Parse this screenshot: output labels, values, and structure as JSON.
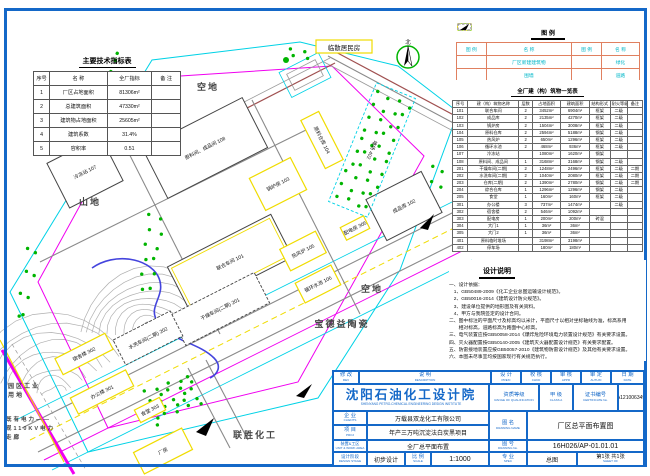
{
  "palette": {
    "blue": "#1468c8",
    "cyan": "#00d2e6",
    "magenta": "#f000f0",
    "yellow": "#f0dc00",
    "green": "#00b400",
    "road_gray": "#8a8a8a",
    "pond_blue": "#4444dd",
    "legend_border": "#e08060"
  },
  "indicators_table": {
    "title": "主要技术指标表",
    "headers": [
      "序号",
      "名  称",
      "全厂指标",
      "备 注"
    ],
    "rows": [
      [
        "1",
        "厂区占地面积",
        "81306m²",
        ""
      ],
      [
        "2",
        "总建筑面积",
        "47330m²",
        ""
      ],
      [
        "3",
        "建筑物占地面积",
        "25605m²",
        ""
      ],
      [
        "4",
        "建筑系数",
        "31.4%",
        ""
      ],
      [
        "5",
        "容积率",
        "0.51",
        ""
      ]
    ]
  },
  "legend": {
    "title": "图  例",
    "headers": [
      "图  例",
      "名  称",
      "图  例",
      "名  称"
    ],
    "rows": [
      {
        "glyph": "new-building",
        "name": "厂区新建建筑物",
        "glyph2": "greenery",
        "name2": "绿化"
      },
      {
        "glyph": "fence",
        "name": "围墙",
        "glyph2": "road",
        "name2": "道路"
      },
      {
        "glyph": "old-building",
        "name": "厂区原有建筑物",
        "glyph2": "gate",
        "name2": "出入口"
      }
    ]
  },
  "buildings_table": {
    "title": "全厂建（构）筑物一览表",
    "headers": [
      "序号",
      "建（构）筑物名称",
      "层数",
      "占地面积",
      "建筑面积",
      "结构形式",
      "耐火等级",
      "备注"
    ],
    "rows": [
      [
        "101",
        "联合车间",
        "2",
        "3452m²",
        "6904m²",
        "框架",
        "二级",
        ""
      ],
      [
        "102",
        "成品库",
        "2",
        "2135m²",
        "4270m²",
        "框架",
        "二级",
        ""
      ],
      [
        "103",
        "锅炉房",
        "2",
        "1504m²",
        "3008m²",
        "框架",
        "二级",
        ""
      ],
      [
        "104",
        "原料仓库",
        "2",
        "2594m²",
        "5188m²",
        "钢架",
        "二级",
        ""
      ],
      [
        "105",
        "热风炉",
        "2",
        "650m²",
        "1296m²",
        "框架",
        "二级",
        ""
      ],
      [
        "106",
        "循环水池",
        "2",
        "468m²",
        "936m²",
        "框架",
        "二级",
        ""
      ],
      [
        "107",
        "冷冻站",
        "",
        "1080m²",
        "1620m²",
        "钢架",
        "",
        ""
      ],
      [
        "108",
        "原料间、成品间",
        "1",
        "3168m²",
        "3168m²",
        "钢架",
        "二级",
        ""
      ],
      [
        "201",
        "干燥车间(二期)",
        "2",
        "1248m²",
        "2496m²",
        "框架",
        "二级",
        "二期"
      ],
      [
        "202",
        "水洗车间(二期)",
        "2",
        "1040m²",
        "2080m²",
        "框架",
        "二级",
        "二期"
      ],
      [
        "203",
        "仓库(二期)",
        "2",
        "1390m²",
        "2780m²",
        "钢架",
        "二级",
        "二期"
      ],
      [
        "204",
        "综合仓库",
        "1",
        "1296m²",
        "1296m²",
        "钢架",
        "二级",
        ""
      ],
      [
        "205",
        "食堂",
        "1",
        "160m²",
        "160m²",
        "框架",
        "二级",
        ""
      ],
      [
        "301",
        "办公楼",
        "3",
        "737m²",
        "1474m²",
        "",
        "二级",
        ""
      ],
      [
        "302",
        "宿舍楼",
        "2",
        "546m²",
        "1092m²",
        "",
        "",
        ""
      ],
      [
        "303",
        "配电房",
        "1",
        "200m²",
        "200m²",
        "砖混",
        "",
        ""
      ],
      [
        "304",
        "大门1",
        "1",
        "36m²",
        "36m²",
        "",
        "",
        ""
      ],
      [
        "305",
        "大门2",
        "1",
        "36m²",
        "36m²",
        "",
        "",
        ""
      ],
      [
        "401",
        "原料临时堆场",
        "",
        "3198m²",
        "3198m²",
        "",
        "",
        ""
      ],
      [
        "402",
        "停车场",
        "",
        "180m²",
        "180m²",
        "",
        "",
        ""
      ]
    ]
  },
  "notes": {
    "title": "设计说明",
    "lines": [
      "一、设计依据：",
      "　1、GB50489-2009《化工企业总图运输设计规范》。",
      "　2、GB50016-2014《建筑设计防火规范》。",
      "　3、建设单位提供的地形图及有关资料。",
      "　4、甲方与我院签定的设计合同。",
      "二、图中标注的平面尺寸及标高均以米计，平面尺寸以相对坐标轴线为准，标高系用",
      "　　相对标高，道路标高为路面中心标高。",
      "三、电气装置应按GB50058-2014《爆炸危险环境电力装置设计规范》有关要求设置。",
      "四、灭火器配置按GB50140-2005《建筑灭火器配置设计规范》有关要求配置。",
      "五、防雷接地装置应按GB50057-2010《建筑物防雷设计规范》及其他有关要求设置。",
      "六、本图未尽事宜均按国家现行有关规范执行。"
    ]
  },
  "title_block": {
    "rev": {
      "cn": "修 改",
      "en": "REV"
    },
    "desc": {
      "cn": "说  明",
      "en": "DESCRIPTION"
    },
    "design": {
      "cn": "设 计",
      "en": "PRE'D"
    },
    "check": {
      "cn": "校 核",
      "en": "CHKD"
    },
    "appr": {
      "cn": "审 核",
      "en": "APPR"
    },
    "auth": {
      "cn": "审 定",
      "en": "AUTH'D"
    },
    "date": {
      "cn": "日 期",
      "en": "DATE"
    },
    "institute": {
      "cn": "沈阳石油化工设计院",
      "en": "SHENYANG PETRO-CHEMICAL ENGINEERING DESIGN INSTITUTE"
    },
    "qual": {
      "cn": "资质等级",
      "en": "RANGE OF QUALIFICATION"
    },
    "class": {
      "cn": "甲 级",
      "en": "CLASS A"
    },
    "cert": {
      "cn": "证书编号",
      "en": "CERTIFICATE No."
    },
    "cert_no": "A121006349",
    "clients": {
      "cn": "企 业",
      "en": "CLIENTS"
    },
    "clients_value": "万载县双龙化工有限公司",
    "proj": {
      "cn": "项 目",
      "en": "PROJ"
    },
    "proj_value": "年产三万吨沉淀法白炭黑项目",
    "unit": {
      "cn": "装置&工区",
      "en": "UNIT & WORK AREA"
    },
    "unit_value": "全厂总平面布置",
    "stage": {
      "cn": "设计阶段",
      "en": "DESIGN STAGE"
    },
    "stage_value": "初步设计",
    "scale": {
      "cn": "比 例",
      "en": "SCALE"
    },
    "scale_value": "1:1000",
    "dname": {
      "cn": "图 名",
      "en": "DRAWING NAME"
    },
    "dname_value": "厂区总平面布置图",
    "dno": {
      "cn": "图 号",
      "en": "DRAWING No."
    },
    "dno_value": "16H026/AP-01.01.01",
    "spec": {
      "cn": "专 业",
      "en": "SPEC"
    },
    "spec_value": "总图",
    "sheet": {
      "cn": "第1张 共1张",
      "en": "SHEET  OF"
    }
  },
  "plan": {
    "residents": "临散居民房",
    "north_label": "北",
    "area_labels": [
      {
        "text": "空地",
        "x": 208,
        "y": 90,
        "s": 9,
        "a": "m"
      },
      {
        "text": "山地",
        "x": 90,
        "y": 205,
        "s": 9,
        "a": "m"
      },
      {
        "text": "空地",
        "x": 372,
        "y": 292,
        "s": 9,
        "a": "m"
      },
      {
        "text": "宝德益陶瓷",
        "x": 342,
        "y": 327,
        "s": 9,
        "a": "m"
      },
      {
        "text": "联胜化工",
        "x": 255,
        "y": 438,
        "s": 9,
        "a": "m"
      },
      {
        "text": "园区工业",
        "x": 8,
        "y": 388,
        "s": 6,
        "a": "s"
      },
      {
        "text": "用地",
        "x": 8,
        "y": 397,
        "s": 6,
        "a": "s"
      },
      {
        "text": "既有电力——",
        "x": 6,
        "y": 421,
        "s": 5.5,
        "a": "s"
      },
      {
        "text": "现110KV电力",
        "x": 6,
        "y": 430,
        "s": 5.5,
        "a": "s"
      },
      {
        "text": "走廊",
        "x": 6,
        "y": 439,
        "s": 5.5,
        "a": "s"
      }
    ],
    "buildings": [
      {
        "label": "冷冻站 107",
        "cx": 85,
        "cy": 172,
        "w": 60,
        "h": 50,
        "cls": "b-black"
      },
      {
        "label": "原料间、成品间 108",
        "cx": 205,
        "cy": 148,
        "w": 112,
        "h": 56,
        "cls": "b-black"
      },
      {
        "label": "锅炉房 103",
        "cx": 278,
        "cy": 184,
        "w": 46,
        "h": 36,
        "cls": "b-yellow"
      },
      {
        "label": "原料仓库 104",
        "cx": 322,
        "cy": 140,
        "w": 20,
        "h": 54,
        "cls": "b-yellow"
      },
      {
        "label": "成品库 102",
        "cx": 404,
        "cy": 206,
        "w": 62,
        "h": 46,
        "cls": "b-black"
      },
      {
        "label": "联合车间 101",
        "cx": 230,
        "cy": 262,
        "w": 116,
        "h": 48,
        "cls": "b-black",
        "inner": true
      },
      {
        "label": "热风炉 105",
        "cx": 303,
        "cy": 251,
        "w": 40,
        "h": 24,
        "cls": "b-yellow"
      },
      {
        "label": "循环水池 106",
        "cx": 318,
        "cy": 284,
        "w": 40,
        "h": 22,
        "cls": "b-yellow"
      },
      {
        "label": "干燥车间(二期) 201",
        "cx": 220,
        "cy": 309,
        "w": 94,
        "h": 34,
        "cls": "b-dashed"
      },
      {
        "label": "水洗车间(二期) 202",
        "cx": 148,
        "cy": 338,
        "w": 64,
        "h": 28,
        "cls": "b-dashed"
      },
      {
        "label": "宿舍楼 302",
        "cx": 84,
        "cy": 354,
        "w": 56,
        "h": 18,
        "cls": "b-yellow"
      },
      {
        "label": "办公楼 301",
        "cx": 102,
        "cy": 392,
        "w": 62,
        "h": 18,
        "cls": "b-yellow"
      },
      {
        "label": "食堂 303",
        "cx": 150,
        "cy": 410,
        "w": 28,
        "h": 14,
        "cls": "b-yellow"
      },
      {
        "label": "配电房 305",
        "cx": 355,
        "cy": 228,
        "w": 26,
        "h": 14,
        "cls": "b-yellow"
      },
      {
        "label": "厂房",
        "cx": 370,
        "cy": 412,
        "w": 58,
        "h": 28,
        "cls": "b-yellow"
      },
      {
        "label": "厂房",
        "cx": 163,
        "cy": 451,
        "w": 54,
        "h": 24,
        "cls": "b-yellow"
      },
      {
        "label": "堆场 402",
        "cx": 372,
        "cy": 150,
        "w": 42,
        "h": 128,
        "cls": "b-cyan",
        "rot": 22
      }
    ],
    "tree_clusters": [
      {
        "x": 352,
        "y": 90,
        "w": 42,
        "h": 122,
        "rot": 22,
        "count": 40
      },
      {
        "x": 62,
        "y": 78,
        "w": 84,
        "h": 16,
        "rot": -58,
        "count": 10
      },
      {
        "x": 140,
        "y": 210,
        "w": 22,
        "h": 86,
        "rot": 8,
        "count": 12
      },
      {
        "x": 146,
        "y": 380,
        "w": 56,
        "h": 42,
        "rot": -20,
        "count": 26
      },
      {
        "x": 286,
        "y": 48,
        "w": 26,
        "h": 12,
        "rot": 0,
        "count": 4
      },
      {
        "x": 424,
        "y": 162,
        "w": 18,
        "h": 58,
        "rot": 15,
        "count": 8
      },
      {
        "x": 20,
        "y": 240,
        "w": 14,
        "h": 88,
        "rot": 10,
        "count": 8
      }
    ]
  }
}
